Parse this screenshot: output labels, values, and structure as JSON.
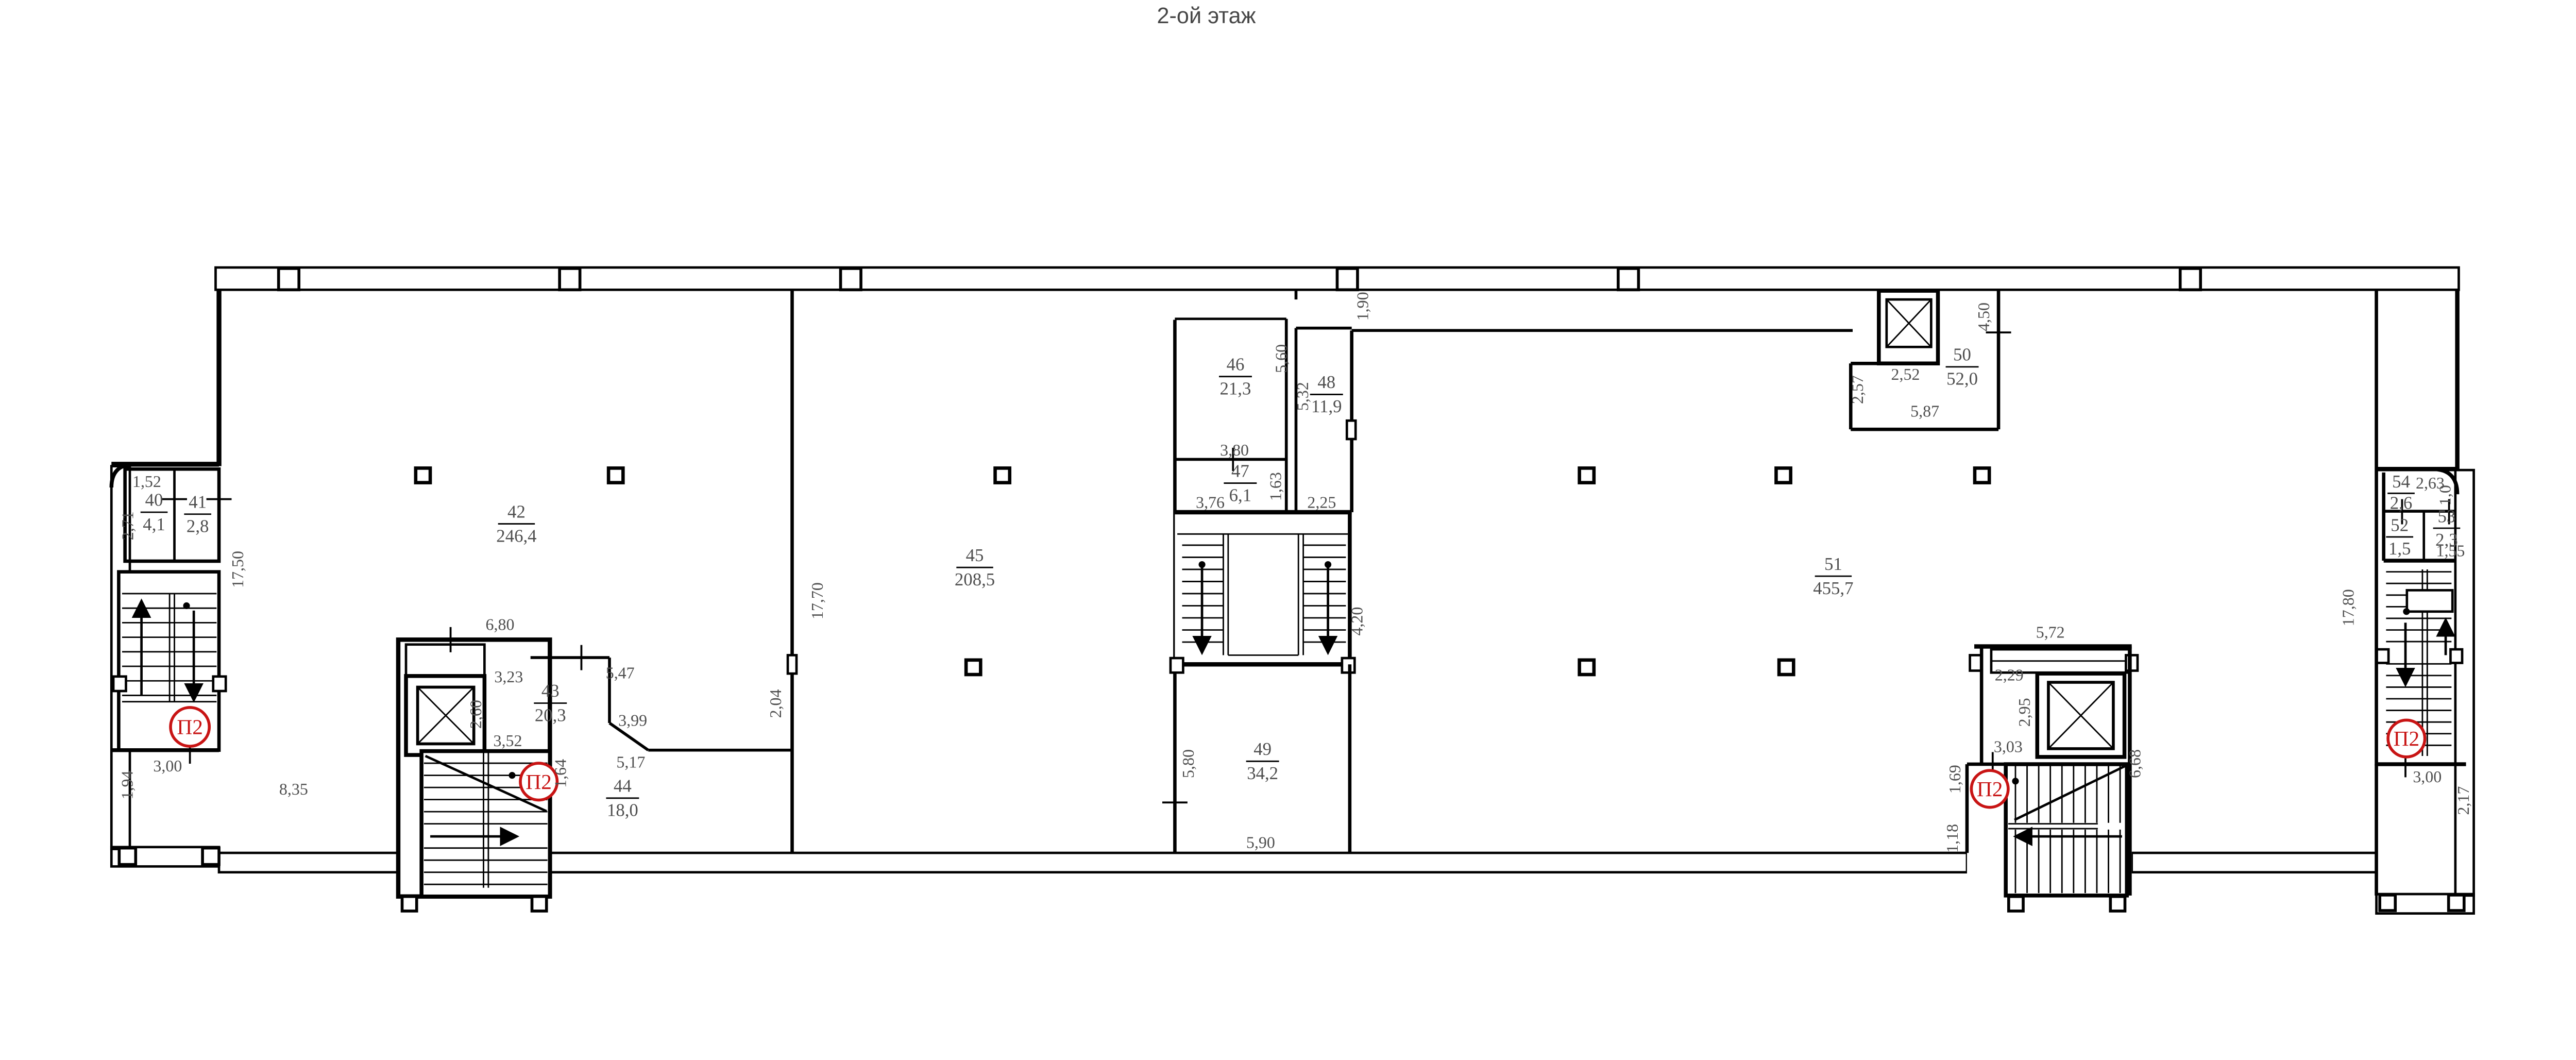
{
  "title": "2-ой этаж",
  "colors": {
    "wall": "#000000",
    "text": "#4f4f4f",
    "stair_badge": "#c81414"
  },
  "stairs": {
    "mark": "П2"
  },
  "rooms": {
    "r40": {
      "num": "40",
      "area": "4,1"
    },
    "r41": {
      "num": "41",
      "area": "2,8"
    },
    "r42": {
      "num": "42",
      "area": "246,4"
    },
    "r43": {
      "num": "43",
      "area": "20,3"
    },
    "r44": {
      "num": "44",
      "area": "18,0"
    },
    "r45": {
      "num": "45",
      "area": "208,5"
    },
    "r46": {
      "num": "46",
      "area": "21,3"
    },
    "r47": {
      "num": "47",
      "area": "6,1"
    },
    "r48": {
      "num": "48",
      "area": "11,9"
    },
    "r49": {
      "num": "49",
      "area": "34,2"
    },
    "r50": {
      "num": "50",
      "area": "52,0"
    },
    "r51": {
      "num": "51",
      "area": "455,7"
    },
    "r52": {
      "num": "52",
      "area": "1,5"
    },
    "r53": {
      "num": "53",
      "area": "2,3"
    },
    "r54": {
      "num": "54",
      "area": "2,6"
    }
  },
  "dims": {
    "w1_52": "1,52",
    "w2_71": "2,71",
    "w17_50": "17,50",
    "w3_00_left": "3,00",
    "w1_94": "1,94",
    "w8_35": "8,35",
    "w6_80": "6,80",
    "w3_23": "3,23",
    "w2_60": "2,60",
    "w3_52": "3,52",
    "w1_64": "1,64",
    "w5_47": "5,47",
    "w3_99": "3,99",
    "w5_17": "5,17",
    "w2_04": "2,04",
    "w17_70": "17,70",
    "w5_60": "5,60",
    "w5_32": "5,32",
    "w3_80": "3,80",
    "w3_76": "3,76",
    "w1_63": "1,63",
    "w2_25": "2,25",
    "w1_90": "1,90",
    "w4_20": "4,20",
    "w5_80": "5,80",
    "w5_90": "5,90",
    "w2_52": "2,52",
    "w2_57": "2,57",
    "w5_87": "5,87",
    "w4_50": "4,50",
    "w2_63": "2,63",
    "w1_0": "1,0",
    "w1_55": "1,55",
    "w17_80": "17,80",
    "w5_72": "5,72",
    "w2_29": "2,29",
    "w2_95": "2,95",
    "w3_03": "3,03",
    "w1_69": "1,69",
    "w1_18": "1,18",
    "w6_68": "6,68",
    "w3_00_right": "3,00",
    "w2_17": "2,17"
  }
}
